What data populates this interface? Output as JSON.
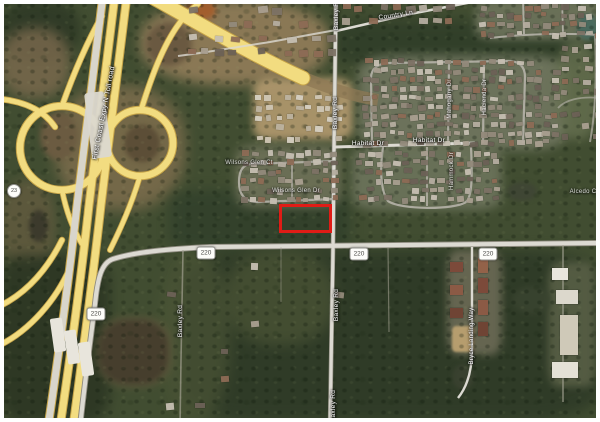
{
  "map": {
    "kind": "satellite-imagery",
    "annotation": {
      "parcel_outline": "red-rectangle-highlight",
      "parcel_outline_color": "#e01c16"
    },
    "shields": {
      "toll_route": "23",
      "county_route": "220"
    },
    "roads": {
      "highway_name": "First Coast Expy N Toll road",
      "baxley_rd": "Baxley Rd",
      "baxley_rd_south": "Baxley Rd",
      "habitat_dr": "Habitat Dr",
      "country_ln": "Country Ln",
      "bryce_landing_way": "Bryce Landing Way"
    },
    "small_streets": {
      "wilsons_glen_ct": "Wilsons Glen Ct",
      "wilsons_glen_dr": "Wilsons Glen Dr",
      "mahogany_dr": "Mahogany Dr",
      "hacienda_dr": "Hacienda Dr",
      "hammock_dr": "Hammock Dr",
      "alcedo_ct": "Alcedo Ct"
    },
    "colors": {
      "highway_yellow": "#f2dc80",
      "road_white": "#dcdad2",
      "forest_green": "#2e3a27",
      "dirt_tan": "#a18a62",
      "water_dark": "#463e2d"
    }
  }
}
